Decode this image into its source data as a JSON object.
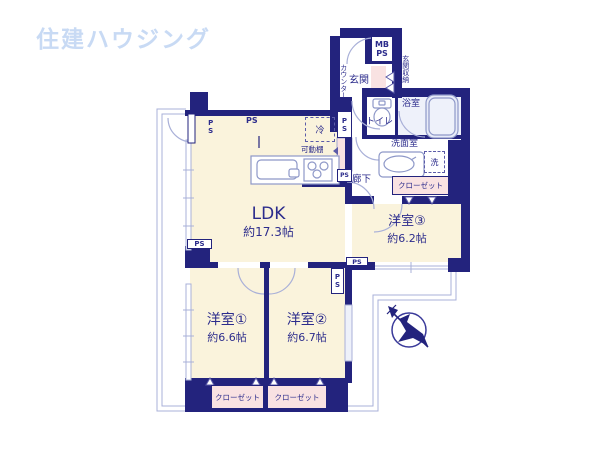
{
  "logo": "住建ハウジング",
  "rooms": {
    "ldk": {
      "name": "LDK",
      "size": "約17.3帖"
    },
    "bed1": {
      "name": "洋室①",
      "size": "約6.6帖"
    },
    "bed2": {
      "name": "洋室②",
      "size": "約6.7帖"
    },
    "bed3": {
      "name": "洋室③",
      "size": "約6.2帖"
    }
  },
  "labels": {
    "genkan": "玄関",
    "counter": "カウンター",
    "genkan_storage": "玄関収納",
    "mb": "MB",
    "ps": "PS",
    "toilet": "トイレ",
    "bath": "浴室",
    "washroom": "洗面室",
    "washer": "洗",
    "closet": "クローゼット",
    "hallway": "廊下",
    "fridge": "冷",
    "movable_shelf": "可動棚"
  },
  "colors": {
    "wall": "#23237d",
    "room_floor": "#faf3dc",
    "accent_pink": "#f9e2e2",
    "thin_line": "#a9b0d8",
    "fixture_line": "#8e98c8",
    "text": "#2c2c8c",
    "logo": "#c8daf4",
    "bath_floor": "#eef1fa"
  }
}
